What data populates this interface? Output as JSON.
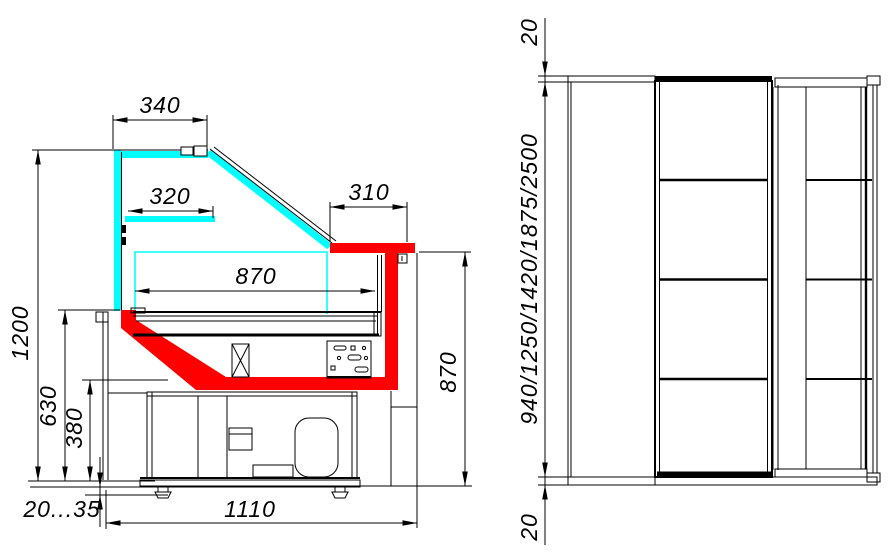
{
  "colors": {
    "glass": "#00ffff",
    "highlight": "#ff0000",
    "line": "#000000",
    "background": "#ffffff"
  },
  "section_view": {
    "dim_340": "340",
    "dim_320": "320",
    "dim_310": "310",
    "dim_870_width": "870",
    "dim_870_height": "870",
    "dim_1200": "1200",
    "dim_630": "630",
    "dim_380": "380",
    "dim_foot_height": "20...35",
    "dim_1110": "1110"
  },
  "plan_view": {
    "dim_top_overhang": "20",
    "dim_lengths": "940/1250/1420/1875/2500",
    "dim_bottom_overhang": "20"
  }
}
